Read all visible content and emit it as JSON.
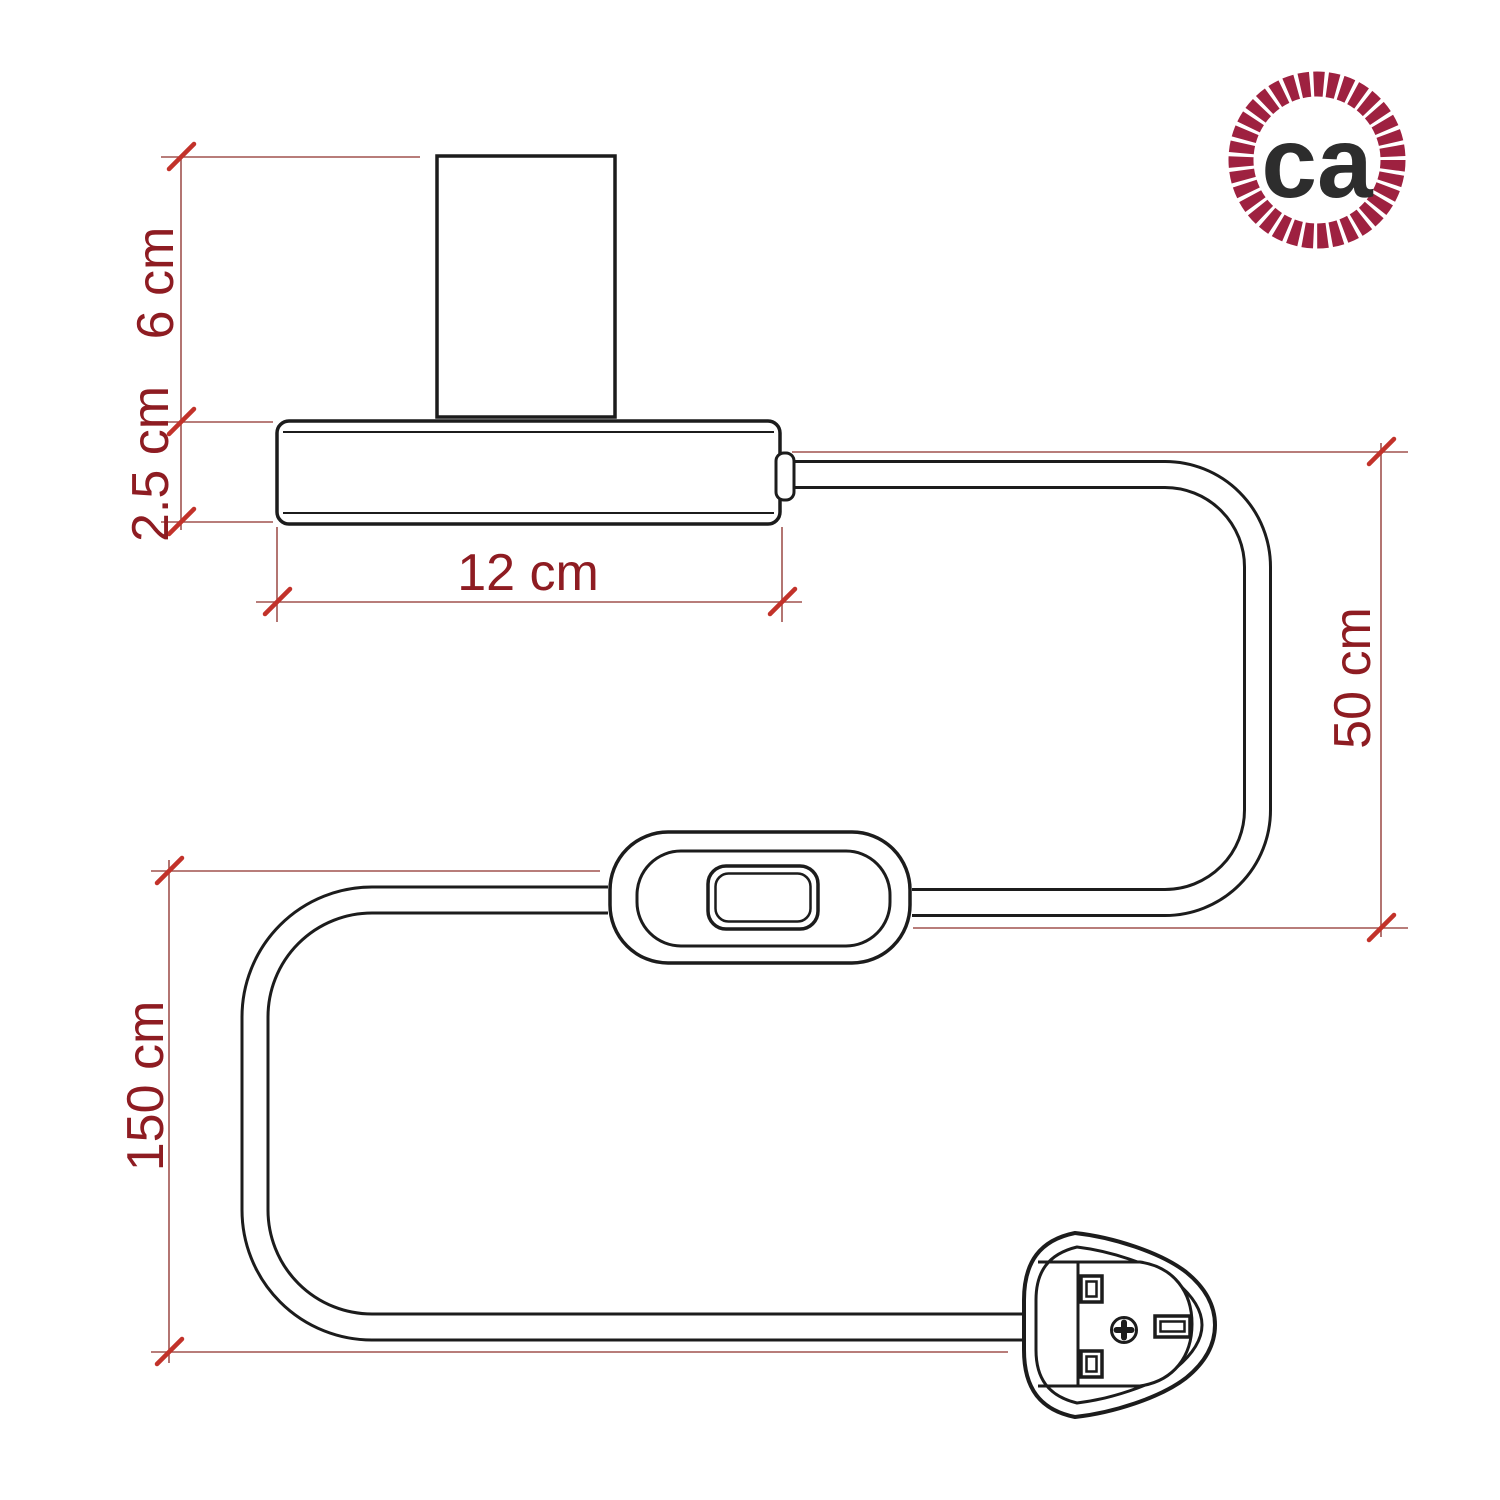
{
  "labels": {
    "socket_height": "6 cm",
    "base_thickness": "2.5 cm",
    "base_width": "12 cm",
    "cable_base_to_switch": "50 cm",
    "cable_switch_to_plug": "150 cm"
  },
  "logo": {
    "text": "ca"
  },
  "colors": {
    "background": "#ffffff",
    "drawing_outline": "#1c1c1c",
    "dimension_line": "#a0524e",
    "dimension_tick": "#c2322a",
    "dimension_label": "#8e1c22",
    "logo_ring": "#9e2140",
    "logo_text": "#2d2d2d"
  }
}
